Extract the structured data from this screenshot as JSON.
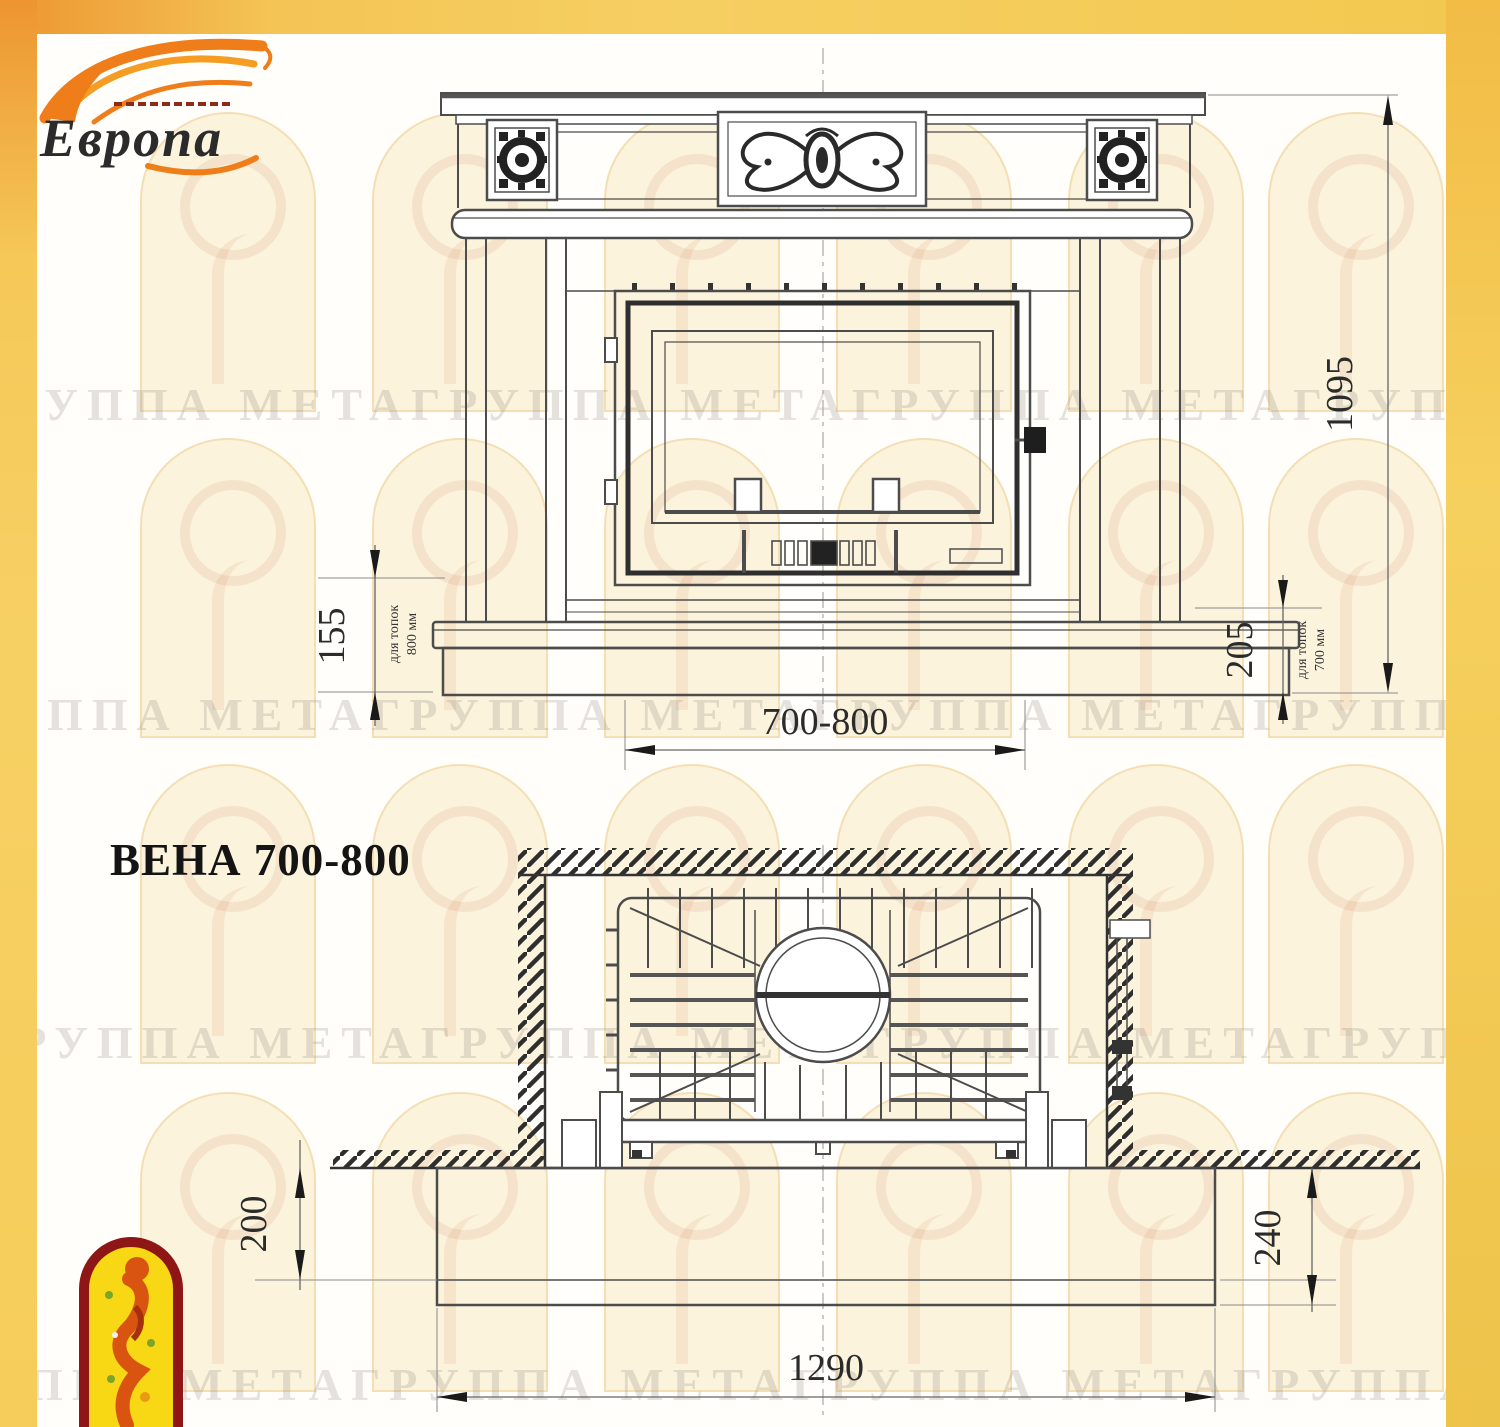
{
  "logo": {
    "brand": "Европа"
  },
  "page": {
    "title": "ВЕНА 700-800"
  },
  "watermark": {
    "text": "ГРУППА МЕТАГРУППА МЕТАГРУППА МЕТАГРУППА МЕТА"
  },
  "front_view": {
    "dim_total_height": "1095",
    "dim_opening_width": "700-800",
    "dim_plinth_left": "155",
    "note_left_1": "для топок",
    "note_left_2": "800 мм",
    "dim_plinth_right": "205",
    "note_right_1": "для топок",
    "note_right_2": "700 мм"
  },
  "plan_view": {
    "dim_left_depth": "200",
    "dim_right_depth": "240",
    "dim_width": "1290"
  }
}
